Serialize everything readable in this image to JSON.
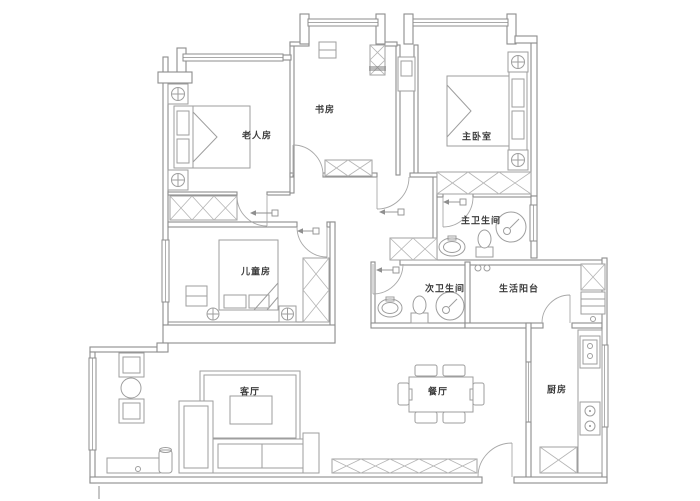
{
  "page": {
    "background": "#ffffff"
  },
  "floor_plan": {
    "type": "apartment-floor-plan",
    "rooms": [
      {
        "name": "老人房"
      },
      {
        "name": "书房"
      },
      {
        "name": "主卧室"
      },
      {
        "name": "主卫生间"
      },
      {
        "name": "儿童房"
      },
      {
        "name": "次卫生间"
      },
      {
        "name": "生活阳台"
      },
      {
        "name": "客厅"
      },
      {
        "name": "餐厅"
      },
      {
        "name": "厨房"
      }
    ],
    "colors": {
      "wall_line": "#8d8d8d",
      "furniture_line": "#9e9e9e",
      "hatch_line": "#b5b5b5",
      "label_text": "#3c3c3c",
      "background": "#ffffff"
    }
  }
}
